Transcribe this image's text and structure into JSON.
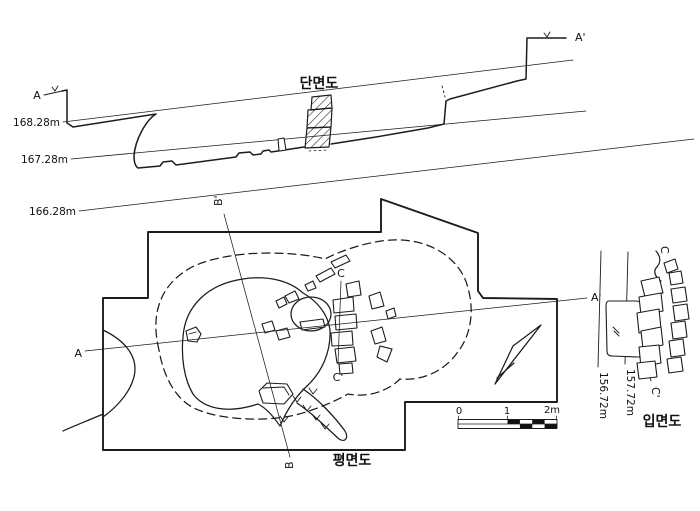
{
  "meta": {
    "background": "#ffffff",
    "ink": "#1c1c1c",
    "description": "Archaeological feature drawing sheet: cross-section (top), plan (center), stone-row elevation (right)"
  },
  "section": {
    "title": "단면도",
    "label_a": "A",
    "label_a_prime": "A'",
    "datum_labels": [
      "168.28m",
      "167.28m",
      "166.28m"
    ]
  },
  "plan": {
    "title": "평면도",
    "label_a": "A",
    "label_a_prime": "A'",
    "label_b": "B",
    "label_b_prime": "B'",
    "label_c": "C",
    "label_c_prime": "C'"
  },
  "elevation": {
    "title": "입면도",
    "label_c": "C",
    "label_c_prime": "C'",
    "datum_labels": [
      "156.72m",
      "157.72m"
    ]
  },
  "scale_bar": {
    "ticks": [
      "0",
      "1",
      "2m"
    ]
  }
}
